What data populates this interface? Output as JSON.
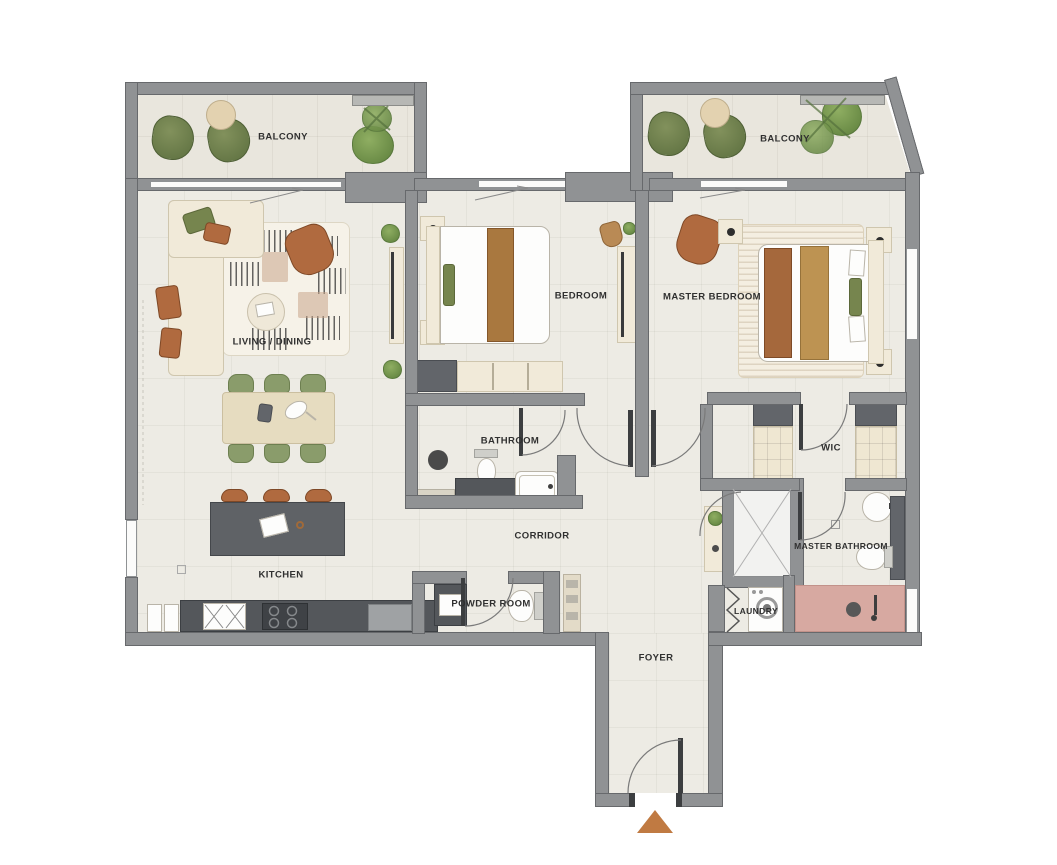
{
  "plan_type": "residential-apartment-floor-plan",
  "rooms": {
    "balcony_left": {
      "label": "BALCONY"
    },
    "balcony_right": {
      "label": "BALCONY"
    },
    "living_dining": {
      "label": "LIVING / DINING"
    },
    "bedroom": {
      "label": "BEDROOM"
    },
    "master_bedroom": {
      "label": "MASTER BEDROOM"
    },
    "bathroom": {
      "label": "BATHROOM"
    },
    "corridor": {
      "label": "CORRIDOR"
    },
    "kitchen": {
      "label": "KITCHEN"
    },
    "powder_room": {
      "label": "POWDER ROOM"
    },
    "wic": {
      "label": "WIC"
    },
    "master_bathroom": {
      "label": "MASTER BATHROOM"
    },
    "laundry": {
      "label": "LAUNDRY"
    },
    "foyer": {
      "label": "FOYER"
    }
  },
  "icons": {
    "entrance_marker": "triangle-up"
  },
  "colors": {
    "wall": "#909294",
    "floor": "#edebe4",
    "accent_green": "#76854e",
    "accent_rust": "#b06a3f",
    "accent_tan": "#bd9352",
    "shower_pink": "#d7a9a1",
    "counter_dark": "#54575b",
    "entrance_marker": "#c07a42"
  }
}
